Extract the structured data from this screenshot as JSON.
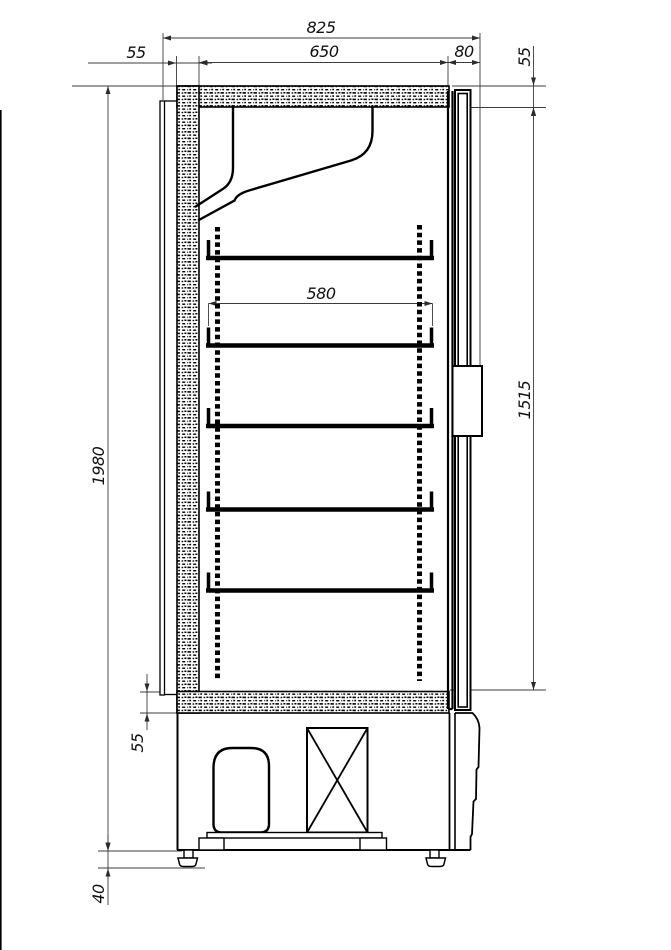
{
  "drawing": {
    "type": "technical-section-view",
    "subject": "upright refrigerated cabinet, side section",
    "colors": {
      "background": "#ffffff",
      "line": "#000000",
      "dimension_line": "#3c3c3c"
    },
    "dimensions": {
      "overall_width": "825",
      "interior_width": "650",
      "door_thickness": "80",
      "back_wall_thickness": "55",
      "top_panel_thickness": "55",
      "shelf_width": "580",
      "overall_height": "1980",
      "interior_height": "1515",
      "bottom_panel_thickness": "55",
      "foot_height": "40"
    }
  }
}
